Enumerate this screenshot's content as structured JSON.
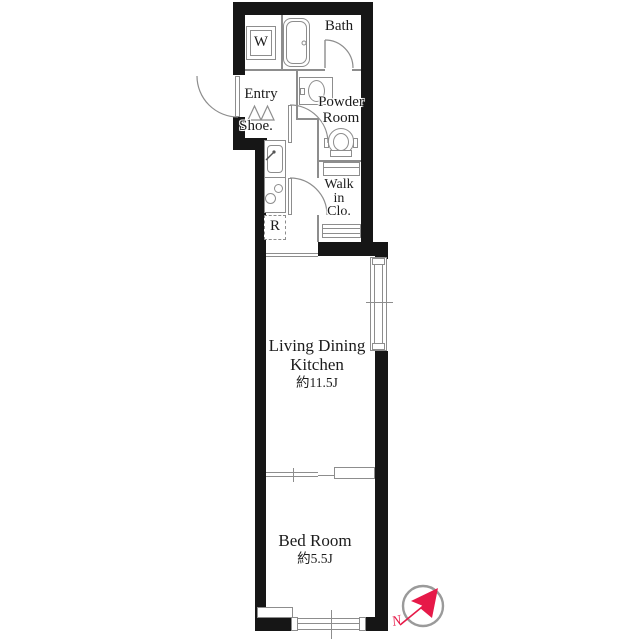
{
  "floor_plan": {
    "rooms": {
      "bath": {
        "label": "Bath"
      },
      "entry": {
        "label": "Entry"
      },
      "shoe_cabinet": {
        "label": "Shoe."
      },
      "powder_room": {
        "label": [
          "Powder",
          "Room"
        ]
      },
      "walk_in_closet": {
        "label": [
          "Walk",
          "in",
          "Clo."
        ]
      },
      "living_dining_kitchen": {
        "label": [
          "Living Dining",
          "Kitchen"
        ],
        "size": "約11.5J"
      },
      "bed_room": {
        "label": "Bed Room",
        "size": "約5.5J"
      }
    },
    "fixtures": {
      "washing_machine": "W",
      "refrigerator": "R"
    },
    "compass": {
      "north_label": "N"
    },
    "colors": {
      "wall": "#161616",
      "interior_line": "#8d8d8d",
      "needle": "#e61948"
    }
  }
}
